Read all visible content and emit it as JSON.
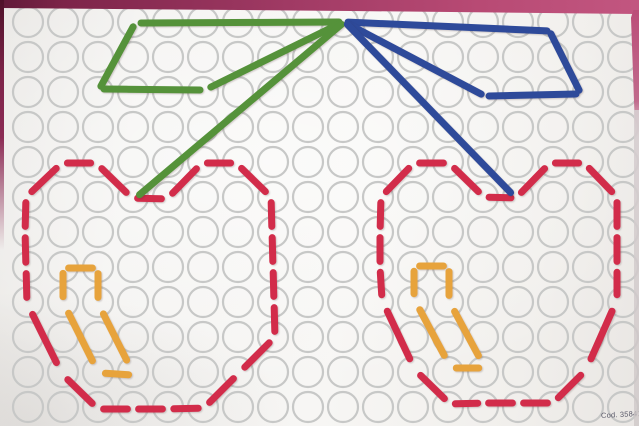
{
  "card": {
    "code_label": "Cod. 35841",
    "colors": {
      "red": "#d22c4a",
      "orange": "#e7a33c",
      "green": "#55923a",
      "blue": "#2e4a9a",
      "hole_ring": "#c7c8c7",
      "board": "#f4f3f1",
      "border_pink": "#b84a74",
      "border_maroon": "#7d2449"
    },
    "grid": {
      "cols": 18,
      "rows": 12,
      "origin_x": 28,
      "origin_y": 22,
      "spacing": 35,
      "hole_radius": 15,
      "ring_width": 2.2
    },
    "figures": [
      {
        "name": "left-cherry-outline",
        "color": "red",
        "width": 7,
        "style": "sticks",
        "points": [
          [
            167,
            199
          ],
          [
            202,
            163
          ],
          [
            236,
            163
          ],
          [
            271,
            197
          ],
          [
            272,
            232
          ],
          [
            273,
            267
          ],
          [
            274,
            302
          ],
          [
            275,
            337
          ],
          [
            239,
            373
          ],
          [
            204,
            408
          ],
          [
            168,
            409
          ],
          [
            133,
            409
          ],
          [
            98,
            409
          ],
          [
            62,
            374
          ],
          [
            27,
            303
          ],
          [
            26,
            268
          ],
          [
            25,
            232
          ],
          [
            26,
            197
          ],
          [
            62,
            163
          ],
          [
            96,
            163
          ],
          [
            132,
            198
          ],
          [
            167,
            199
          ]
        ]
      },
      {
        "name": "right-cherry-outline",
        "color": "red",
        "width": 7,
        "style": "sticks",
        "points": [
          [
            516,
            198
          ],
          [
            550,
            163
          ],
          [
            584,
            163
          ],
          [
            617,
            197
          ],
          [
            617,
            232
          ],
          [
            617,
            267
          ],
          [
            617,
            300
          ],
          [
            586,
            370
          ],
          [
            553,
            403
          ],
          [
            518,
            403
          ],
          [
            483,
            403
          ],
          [
            450,
            404
          ],
          [
            415,
            370
          ],
          [
            382,
            300
          ],
          [
            380,
            267
          ],
          [
            380,
            232
          ],
          [
            381,
            197
          ],
          [
            414,
            163
          ],
          [
            449,
            163
          ],
          [
            484,
            197
          ],
          [
            516,
            198
          ]
        ]
      },
      {
        "name": "left-cherry-highlight",
        "color": "orange",
        "width": 7,
        "style": "sticks",
        "segments": [
          [
            63,
            268,
            98,
            268
          ],
          [
            63,
            268,
            63,
            302
          ],
          [
            98,
            268,
            98,
            303
          ],
          [
            63,
            302,
            98,
            372
          ],
          [
            98,
            303,
            132,
            371
          ],
          [
            100,
            373,
            134,
            375
          ]
        ]
      },
      {
        "name": "right-cherry-highlight",
        "color": "orange",
        "width": 7,
        "style": "sticks",
        "segments": [
          [
            414,
            266,
            449,
            266
          ],
          [
            414,
            266,
            414,
            299
          ],
          [
            449,
            266,
            449,
            301
          ],
          [
            414,
            299,
            450,
            366
          ],
          [
            449,
            301,
            484,
            366
          ],
          [
            451,
            368,
            484,
            368
          ]
        ]
      },
      {
        "name": "left-leaf",
        "color": "green",
        "width": 7,
        "style": "solid",
        "segments": [
          [
            139,
            23,
            341,
            22
          ],
          [
            134,
            25,
            100,
            88
          ],
          [
            102,
            89,
            202,
            90
          ],
          [
            209,
            88,
            341,
            23
          ]
        ]
      },
      {
        "name": "left-stem",
        "color": "green",
        "width": 7,
        "style": "solid",
        "segments": [
          [
            343,
            23,
            138,
            196
          ]
        ]
      },
      {
        "name": "right-leaf",
        "color": "blue",
        "width": 7,
        "style": "solid",
        "segments": [
          [
            346,
            22,
            549,
            31
          ],
          [
            550,
            32,
            580,
            92
          ],
          [
            578,
            94,
            487,
            96
          ],
          [
            483,
            95,
            346,
            23
          ]
        ]
      },
      {
        "name": "right-stem",
        "color": "blue",
        "width": 7,
        "style": "solid",
        "segments": [
          [
            346,
            23,
            512,
            194
          ]
        ]
      }
    ]
  }
}
